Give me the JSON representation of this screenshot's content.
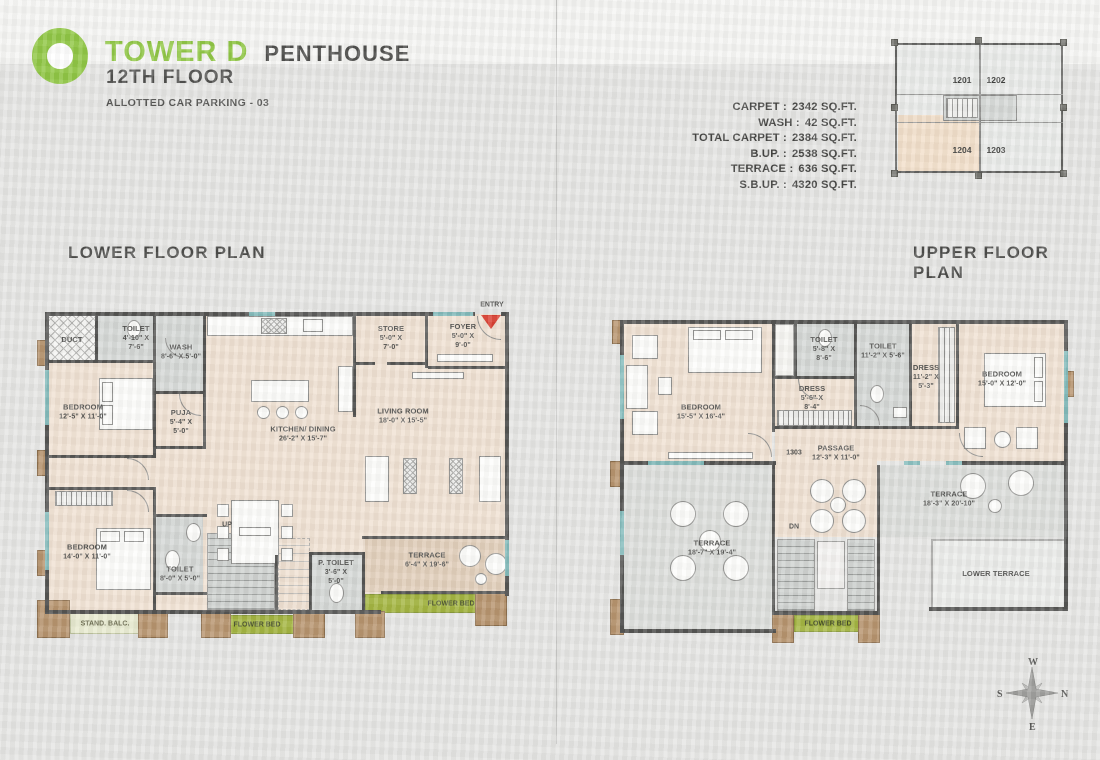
{
  "header": {
    "title": "TOWER D",
    "subtitle": "PENTHOUSE",
    "floor": "12TH FLOOR",
    "parking": "ALLOTTED CAR PARKING - 03"
  },
  "area_table": {
    "rows": [
      {
        "label": "CARPET :",
        "value": "2342 SQ.FT."
      },
      {
        "label": "WASH :",
        "value": "42 SQ.FT."
      },
      {
        "label": "TOTAL CARPET :",
        "value": "2384 SQ.FT."
      },
      {
        "label": "B.UP. :",
        "value": "2538 SQ.FT."
      },
      {
        "label": "TERRACE :",
        "value": "636 SQ.FT."
      },
      {
        "label": "S.B.UP. :",
        "value": "4320 SQ.FT."
      }
    ]
  },
  "key_plan": {
    "units": {
      "u1201": "1201",
      "u1202": "1202",
      "u1203": "1203",
      "u1204": "1204"
    },
    "highlighted_unit": "1204"
  },
  "lower_plan": {
    "title": "LOWER FLOOR PLAN",
    "entry_label": "ENTRY",
    "up_label": "UP",
    "rooms": {
      "duct": {
        "name": "DUCT"
      },
      "toilet1": {
        "name": "TOILET",
        "dims": "4'-10\" X\n7'-6\""
      },
      "wash": {
        "name": "WASH",
        "dims": "8'-6\" X 5'-0\""
      },
      "bedroom1": {
        "name": "BEDROOM",
        "dims": "12'-5\" X 11'-0\""
      },
      "puja": {
        "name": "PUJA",
        "dims": "5'-4\" X\n5'-0\""
      },
      "store": {
        "name": "STORE",
        "dims": "5'-0\" X\n7'-0\""
      },
      "foyer": {
        "name": "FOYER",
        "dims": "5'-0\" X\n9'-0\""
      },
      "kitchen_dining": {
        "name": "KITCHEN/ DINING",
        "dims": "26'-2\" X 15'-7\""
      },
      "living": {
        "name": "LIVING ROOM",
        "dims": "18'-0\" X 15'-5\""
      },
      "bedroom2": {
        "name": "BEDROOM",
        "dims": "14'-0\" X 11'-0\""
      },
      "toilet2": {
        "name": "TOILET",
        "dims": "8'-0\" X 5'-0\""
      },
      "p_toilet": {
        "name": "P. TOILET",
        "dims": "3'-6\" X\n5'-0\""
      },
      "terrace": {
        "name": "TERRACE",
        "dims": "6'-4\" X 19'-6\""
      },
      "stand_balc": {
        "name": "STAND. BALC."
      },
      "flower_bed_right": {
        "name": "FLOWER BED"
      },
      "flower_bed_mid": {
        "name": "FLOWER BED"
      }
    }
  },
  "upper_plan": {
    "title": "UPPER FLOOR PLAN",
    "unit_number": "1303",
    "dn_label": "DN",
    "rooms": {
      "bedroom1": {
        "name": "BEDROOM",
        "dims": "15'-5\" X 16'-4\""
      },
      "toilet1": {
        "name": "TOILET",
        "dims": "5'-8\" X\n8'-6\""
      },
      "dress1": {
        "name": "DRESS",
        "dims": "5'-6\" X\n8'-4\""
      },
      "toilet2": {
        "name": "TOILET",
        "dims": "11'-2\" X 5'-6\""
      },
      "dress2": {
        "name": "DRESS",
        "dims": "11'-2\" X\n5'-3\""
      },
      "bedroom2": {
        "name": "BEDROOM",
        "dims": "15'-0\" X 12'-0\""
      },
      "passage": {
        "name": "PASSAGE",
        "dims": "12'-3\" X 11'-0\""
      },
      "terrace1": {
        "name": "TERRACE",
        "dims": "18'-7\" X 19'-4\""
      },
      "terrace2": {
        "name": "TERRACE",
        "dims": "18'-3\" X 20'-10\""
      },
      "lower_terrace": {
        "name": "LOWER TERRACE"
      },
      "flower_bed": {
        "name": "FLOWER BED"
      }
    }
  },
  "compass": {
    "w": "W",
    "n": "N",
    "e": "E",
    "s": "S"
  },
  "colors": {
    "brand_green": "#8dc63f",
    "flower_green": "#a2b43c",
    "wall_dark": "#4f4f4d",
    "floor_beige": "#f0e1d2",
    "terrace_beige": "#e2cfba",
    "wet_gray": "#d4d7d5",
    "terrace_gray": "#dcdedb",
    "accent_brown": "#b5916a",
    "window_teal": "#7fb9b9",
    "entry_red": "#d9392b",
    "key_highlight": "#f2dfc9"
  }
}
